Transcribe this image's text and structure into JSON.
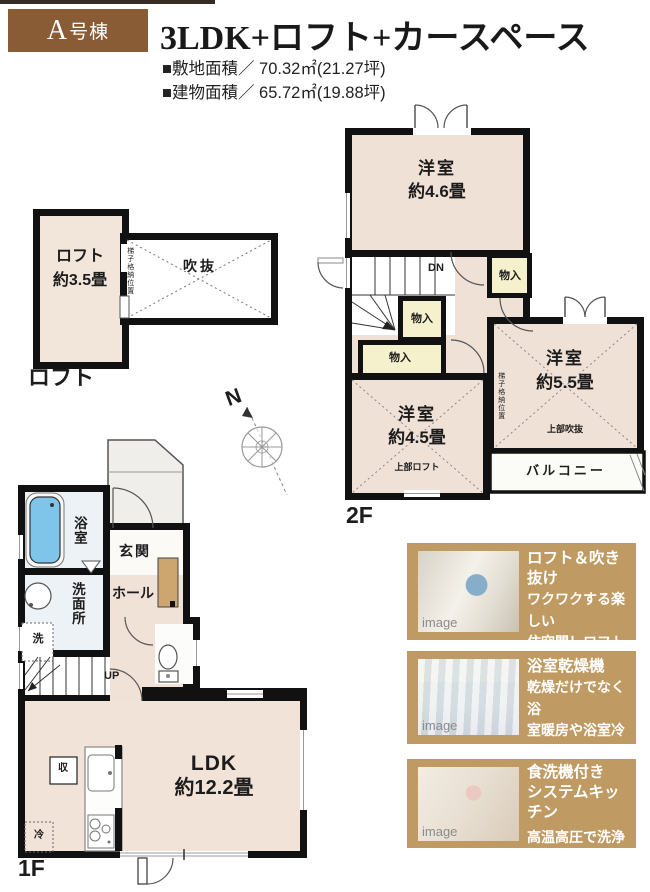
{
  "header": {
    "badge_prefix": "A",
    "badge_suffix": "号棟",
    "title": "3LDK+ロフト+カースペース",
    "site_area": "■敷地面積／ 70.32㎡(21.27坪)",
    "building_area": "■建物面積／ 65.72㎡(19.88坪)"
  },
  "loft": {
    "floor_label": "ロフト",
    "room_name": "ロフト",
    "room_size": "約3.5畳",
    "void_label": "吹抜",
    "ladder_note": "梯子格納位置"
  },
  "floor2": {
    "floor_label": "2F",
    "room1_name": "洋室",
    "room1_size": "約4.6畳",
    "room2_name": "洋室",
    "room2_size": "約4.5畳",
    "room3_name": "洋室",
    "room3_size": "約5.5畳",
    "closet1": "物入",
    "closet2": "物入",
    "closet3": "物入",
    "stairs_down": "DN",
    "balcony": "バルコニー",
    "upper_loft_note": "上部ロフト",
    "upper_void_note": "上部吹抜",
    "ladder_note": "梯子格納位置"
  },
  "floor1": {
    "floor_label": "1F",
    "bath": "浴室",
    "washroom": "洗面所",
    "washer": "洗",
    "entrance": "玄関",
    "hall": "ホール",
    "stairs_up": "UP",
    "ldk_name": "LDK",
    "ldk_size": "約12.2畳",
    "storage": "収",
    "fridge": "冷"
  },
  "compass": {
    "north": "N"
  },
  "features": [
    {
      "title": "ロフト＆吹き抜け",
      "line1": "ワクワクする楽しい",
      "line2": "住空間！ロフトが",
      "line3": "あるプラン。",
      "watermark": "image"
    },
    {
      "title": "浴室乾燥機",
      "line1": "乾燥だけでなく浴",
      "line2": "室暖房や浴室冷房",
      "line3": "と充実の機能。",
      "watermark": "image"
    },
    {
      "title": "食洗機付き",
      "title2": "システムキッチン",
      "line1": "高温高圧で洗浄して",
      "line2": "乾燥までお任せ！",
      "watermark": "image"
    }
  ],
  "colors": {
    "accent_brown": "#8a5c36",
    "feature_tan": "#bf9a62",
    "room_beige": "#f2e3d9",
    "closet_yellow": "#f6f1cd",
    "bath_blue": "#7fc4e9",
    "wall_black": "#111111"
  }
}
